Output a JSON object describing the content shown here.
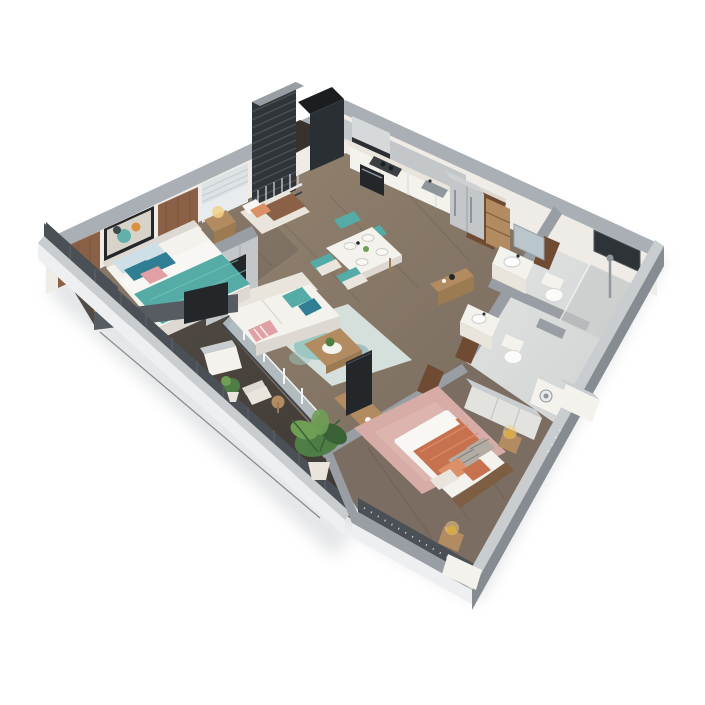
{
  "scene": {
    "kind": "3d-isometric-cutaway-floor-plan-render",
    "subject": "two-bedroom apartment with open kitchen, living-dining area, two bathrooms and wrap balcony",
    "background": "#ffffff",
    "visible_text": "none"
  },
  "palette": {
    "bg": "#ffffff",
    "wallTop": "#a9afb4",
    "wallTopLight": "#c9cdcf",
    "wallFace": "#efece7",
    "wallFaceShade": "#ddd8d1",
    "wallOuterLight": "#edeff0",
    "wallOuter": "#868c91",
    "wallMid": "#989ea3",
    "wallDark": "#4a5055",
    "floorWood": "#8a796c",
    "floorWoodDark": "#6e6257",
    "floorHall": "#7b6d61",
    "deck": "#4f4943",
    "deckDark": "#37322d",
    "tile": "#dcdfde",
    "tileDark": "#c7cbca",
    "teal": "#55aca6",
    "tealDark": "#2f7e93",
    "tealPale": "#cfdfe8",
    "blush": "#e0a0a4",
    "terracotta": "#c8714f",
    "terraLight": "#db9068",
    "rugPink": "#d7aba6",
    "rugTeal": "#d9e5e2",
    "woodLight": "#b28b60",
    "woodMid": "#9c7b52",
    "walnut": "#6f4b34",
    "brown": "#8a6146",
    "headboardWood": "#7d5e42",
    "cream": "#e9e5dd",
    "whiteSoft": "#f4f2ed",
    "frameWhite": "#f8f7f4",
    "dark": "#24272a",
    "metal": "#c3c7c9",
    "steel": "#90979c",
    "gold": "#d9a943",
    "goldGlow": "#f2d28a",
    "leaf": "#4e7d45",
    "leafLight": "#6f9e55",
    "leafDark": "#3a6136",
    "glass": "#b9c7cc",
    "grayFabric": "#b3aca4",
    "orange": "#d9913f"
  },
  "rooms": [
    {
      "id": "master-bedroom",
      "position": "left",
      "items": [
        "double-bed",
        "teal-throw",
        "blue-teal-pink-pillows",
        "headboard",
        "two-nightstands",
        "table-lamps",
        "abstract-wall-art",
        "wood-wall-panels",
        "roller-blind-windows",
        "gray-wardrobe",
        "wall-tv",
        "window-daybed"
      ]
    },
    {
      "id": "living-room",
      "position": "center",
      "items": [
        "white-sofa",
        "teal-cushions",
        "striped-pillow",
        "teal-area-rug",
        "coffee-table",
        "potted-plant",
        "wood-media-console",
        "tv"
      ]
    },
    {
      "id": "dining-area",
      "position": "center-top",
      "items": [
        "white-dining-table",
        "four-teal-chairs",
        "tableware"
      ]
    },
    {
      "id": "kitchen",
      "position": "top",
      "items": [
        "counter-run",
        "stainless-backsplash",
        "range-hood",
        "cooktop",
        "oven",
        "sink",
        "double-door-refrigerator",
        "open-shelf"
      ]
    },
    {
      "id": "entry-hall",
      "position": "top-right",
      "items": [
        "walnut-entrance-door",
        "wood-console-table"
      ]
    },
    {
      "id": "bathroom-1",
      "position": "right-corner",
      "items": [
        "vanity-sink",
        "mirror",
        "toilet",
        "walk-in-shower"
      ]
    },
    {
      "id": "bathroom-2",
      "position": "right",
      "items": [
        "vanity-sink",
        "toilet",
        "washer",
        "walnut-door"
      ]
    },
    {
      "id": "bedroom-2",
      "position": "bottom-right",
      "items": [
        "double-bed",
        "terracotta-bedding",
        "patterned-and-coral-pillows",
        "pink-rug",
        "two-nightstands",
        "gold-sphere-lamps",
        "wardrobe",
        "string-lights"
      ]
    },
    {
      "id": "balcony",
      "position": "bottom-left-edge",
      "items": [
        "dark-wood-deck",
        "parapet",
        "large-potted-plant",
        "small-plant",
        "chair",
        "side-table",
        "wall-sconce",
        "white-divider"
      ]
    },
    {
      "id": "service-loggia",
      "position": "top-corner",
      "items": [
        "dark-louver-screen",
        "railing",
        "shaft",
        "column"
      ]
    }
  ]
}
